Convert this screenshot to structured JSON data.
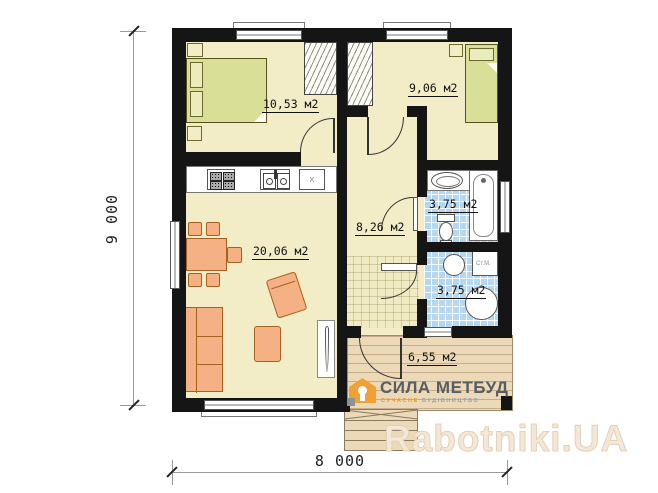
{
  "plan": {
    "rooms": {
      "bedroom1": {
        "area_label": "10,53 м2"
      },
      "bedroom2": {
        "area_label": "9,06 м2"
      },
      "living_kitchen": {
        "area_label": "20,06 м2"
      },
      "hall": {
        "area_label": "8,26 м2"
      },
      "bathroom": {
        "area_label": "3,75 м2"
      },
      "laundry": {
        "area_label": "3,75 м2",
        "washing_machine_label": "Ст.М."
      },
      "terrace": {
        "area_label": "6,55 м2"
      }
    },
    "kitchen": {
      "appliance_label": "x"
    },
    "dimensions": {
      "vertical": "9 000",
      "horizontal": "8 000"
    }
  },
  "watermarks": {
    "builder_name": "СИЛА МЕТБУД",
    "builder_tagline_1": "СУЧАСНЕ",
    "builder_tagline_2": "БУДІВНИЦТВО",
    "portal": "Rabotniki.UA"
  },
  "colors": {
    "wall": "#151515",
    "floor": "#f2edc6",
    "bath_tile": "#b5d8f0",
    "furniture": "#f5b183",
    "bed": "#d9df96",
    "terrace": "#ecd9b8",
    "builder_orange": "#f0a135",
    "portal_text": "#f3e7d5"
  }
}
